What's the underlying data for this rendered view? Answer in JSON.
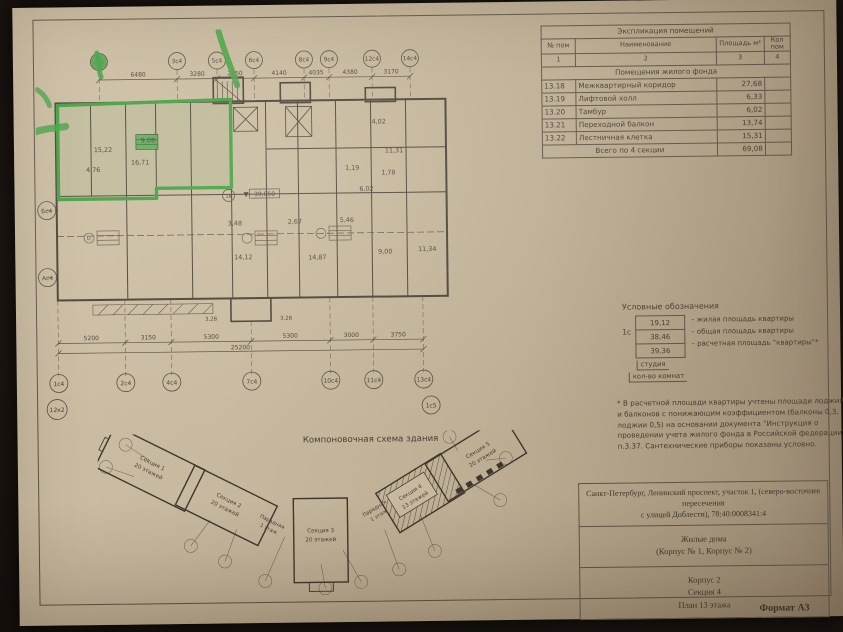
{
  "colors": {
    "highlight": "#3f9e3f",
    "paper": "#c3b59c",
    "ink": "#463d30"
  },
  "explication": {
    "title": "Экспликация помещений",
    "headers": {
      "num": "№ пом",
      "name": "Наименование",
      "area": "Площадь м²",
      "count": "Кол пом"
    },
    "col_nums": [
      "1",
      "2",
      "3",
      "4"
    ],
    "group_header": "Помещения жилого фонда",
    "rows": [
      {
        "num": "13.18",
        "name": "Межквартирный коридор",
        "area": "27,68"
      },
      {
        "num": "13.19",
        "name": "Лифтовой холл",
        "area": "6,33"
      },
      {
        "num": "13.20",
        "name": "Тамбур",
        "area": "6,02"
      },
      {
        "num": "13.21",
        "name": "Переходной балкон",
        "area": "13,74"
      },
      {
        "num": "13.22",
        "name": "Лестничная клетка",
        "area": "15,31"
      }
    ],
    "total_label": "Всего по 4 секции",
    "total_area": "69,08"
  },
  "legend": {
    "title": "Условные обозначения",
    "stamp_type": "1с",
    "rows": [
      {
        "value": "19,12",
        "desc": "– жилая площадь квартиры"
      },
      {
        "value": "38,46",
        "desc": "– общая площадь квартиры"
      },
      {
        "value": "39,36",
        "desc": "– расчетная площадь \"квартиры\"*"
      }
    ],
    "caption_type": "студия",
    "caption_rooms": "кол-во комнат",
    "note": "* В расчетной площади квартиры учтены площади лоджий и балконов с понижающим коэффициентом (балконы 0,3, лоджии 0,5) на основании документа \"Инструкция о проведении учета жилого фонда в Российской федерации\" п.3.37. Сантехнические приборы показаны условно."
  },
  "title_block": {
    "address_line1": "Санкт-Петербург, Ленинский проспект, участок 1, (северо-восточнее пересечения",
    "address_line2": "с улицей Доблести), 78:40:0008341:4",
    "project_line1": "Жилые дома",
    "project_line2": "(Корпус № 1, Корпус № 2)",
    "sheet_line1": "Корпус 2",
    "sheet_line2": "Секция 4",
    "sheet_line3": "План 13 этажа",
    "format": "Формат А3"
  },
  "scheme": {
    "title": "Компоновочная схема здания",
    "sections": [
      {
        "name": "Секция 1",
        "floors": "20 этажей"
      },
      {
        "name": "Секция 2",
        "floors": "20 этажей"
      },
      {
        "name": "Секция 3",
        "floors": "20 этажей"
      },
      {
        "name": "Секция 4",
        "floors": "13 этажей"
      },
      {
        "name": "Секция 5",
        "floors": "20 этажей"
      }
    ],
    "entrances": [
      {
        "name": "Парадная",
        "floors": "1 этаж"
      },
      {
        "name": "Парадная",
        "floors": "1 этаж"
      }
    ]
  },
  "plan": {
    "elevation": "39,050",
    "level_mark": "1в",
    "unit_mark": "1с",
    "axes_top": [
      "2с4",
      "3с4",
      "5с4",
      "6с4",
      "8с4",
      "9с4",
      "12с4",
      "14с4"
    ],
    "dims_top": [
      "6480",
      "3280",
      "2850",
      "4140",
      "4035",
      "4380",
      "3170"
    ],
    "axes_bottom": [
      "1с4",
      "2с4",
      "4с4",
      "7с4",
      "10с4",
      "11с4",
      "13с4"
    ],
    "dims_bottom": [
      "5200",
      "3150",
      "5300",
      "5300",
      "3000",
      "3750"
    ],
    "dim_total": "25200",
    "axes_left": [
      "Бс4",
      "Ас4"
    ],
    "axis_extra_left": "12к2",
    "axis_extra_right": "1с5",
    "dims_small": [
      "3,28",
      "3,28"
    ],
    "areas": [
      "15,22",
      "9,08",
      "16,71",
      "4,76",
      "3,48",
      "2,67",
      "5,46",
      "6,02",
      "14,12",
      "14,87",
      "9,00",
      "11,34",
      "11,31",
      "1,78",
      "4,02",
      "1,19"
    ]
  }
}
